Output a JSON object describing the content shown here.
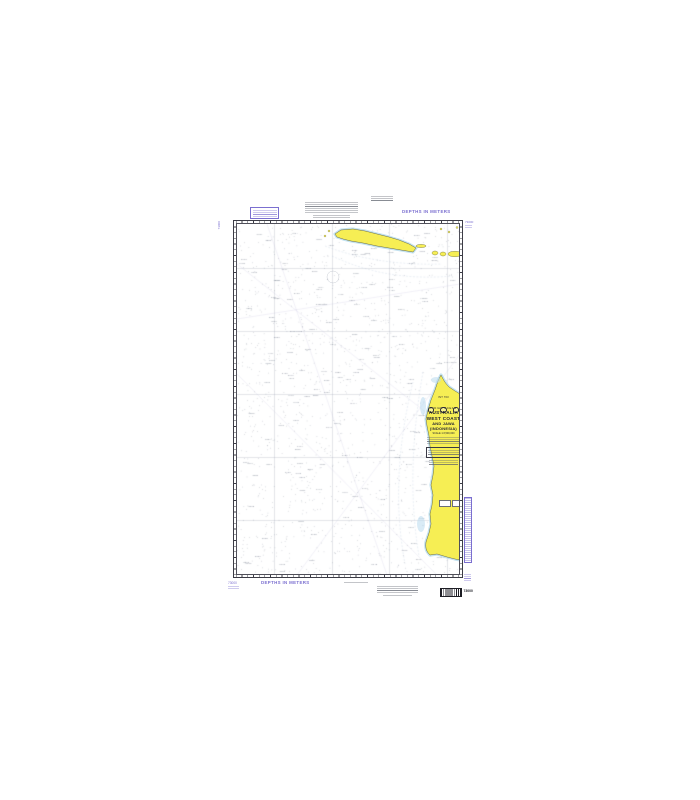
{
  "canvas": {
    "width": 700,
    "height": 800,
    "background": "#ffffff"
  },
  "chart": {
    "kind": "nautical-chart-product-image",
    "number": "73000",
    "int_number": "INT 703",
    "depths_label_top": "DEPTHS IN METERS",
    "depths_label_bottom": "DEPTHS IN METERS",
    "title_block": {
      "eyebrow": "INDIAN OCEAN",
      "title_line1": "AUSTRALIA",
      "title_line2": "WEST COAST",
      "title_line3": "AND JAWA",
      "title_line4": "(INDONESIA)",
      "scale_line": "SCALE 1:3,500,000"
    },
    "margin": {
      "top_left_number": "73000",
      "top_right_number": "73000",
      "bottom_left_number": "73000",
      "barcode_number": "73000"
    },
    "colors": {
      "land": "#f6ee54",
      "land_outline": "#6a6a42",
      "shallow_water": "#c3e2f0",
      "magenta": "#7b6fd0",
      "neatline": "#3c3c46",
      "grid": "rgba(125,135,155,0.55)",
      "sounding": "rgba(85,95,115,0.55)"
    }
  }
}
